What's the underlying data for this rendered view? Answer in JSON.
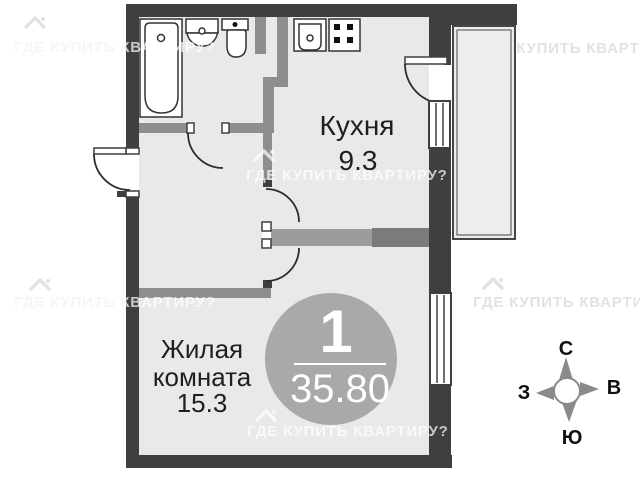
{
  "watermark": {
    "text": "ГДЕ КУПИТЬ КВАРТИРУ?"
  },
  "rooms": {
    "kitchen": {
      "name": "Кухня",
      "area": "9.3"
    },
    "living_room": {
      "name_line1": "Жилая",
      "name_line2": "комната",
      "area": "15.3"
    }
  },
  "badge": {
    "rooms_count": "1",
    "total_area": "35.80"
  },
  "compass": {
    "north": "С",
    "east": "В",
    "south": "Ю",
    "west": "З"
  },
  "fixtures": {
    "bathtub": "bathtub-icon",
    "bathroom_sink": "sink-icon",
    "toilet": "toilet-icon",
    "kitchen_sink": "kitchen-sink-icon",
    "stove": "stove-icon"
  },
  "colors": {
    "outer_wall": "#3f3f3f",
    "inner_wall": "#8e8e8e",
    "room_fill": "#e9e9e9",
    "balcony_fill": "#ededed",
    "badge_fill": "#a9a9a9",
    "label_text": "#1f1f1f"
  }
}
